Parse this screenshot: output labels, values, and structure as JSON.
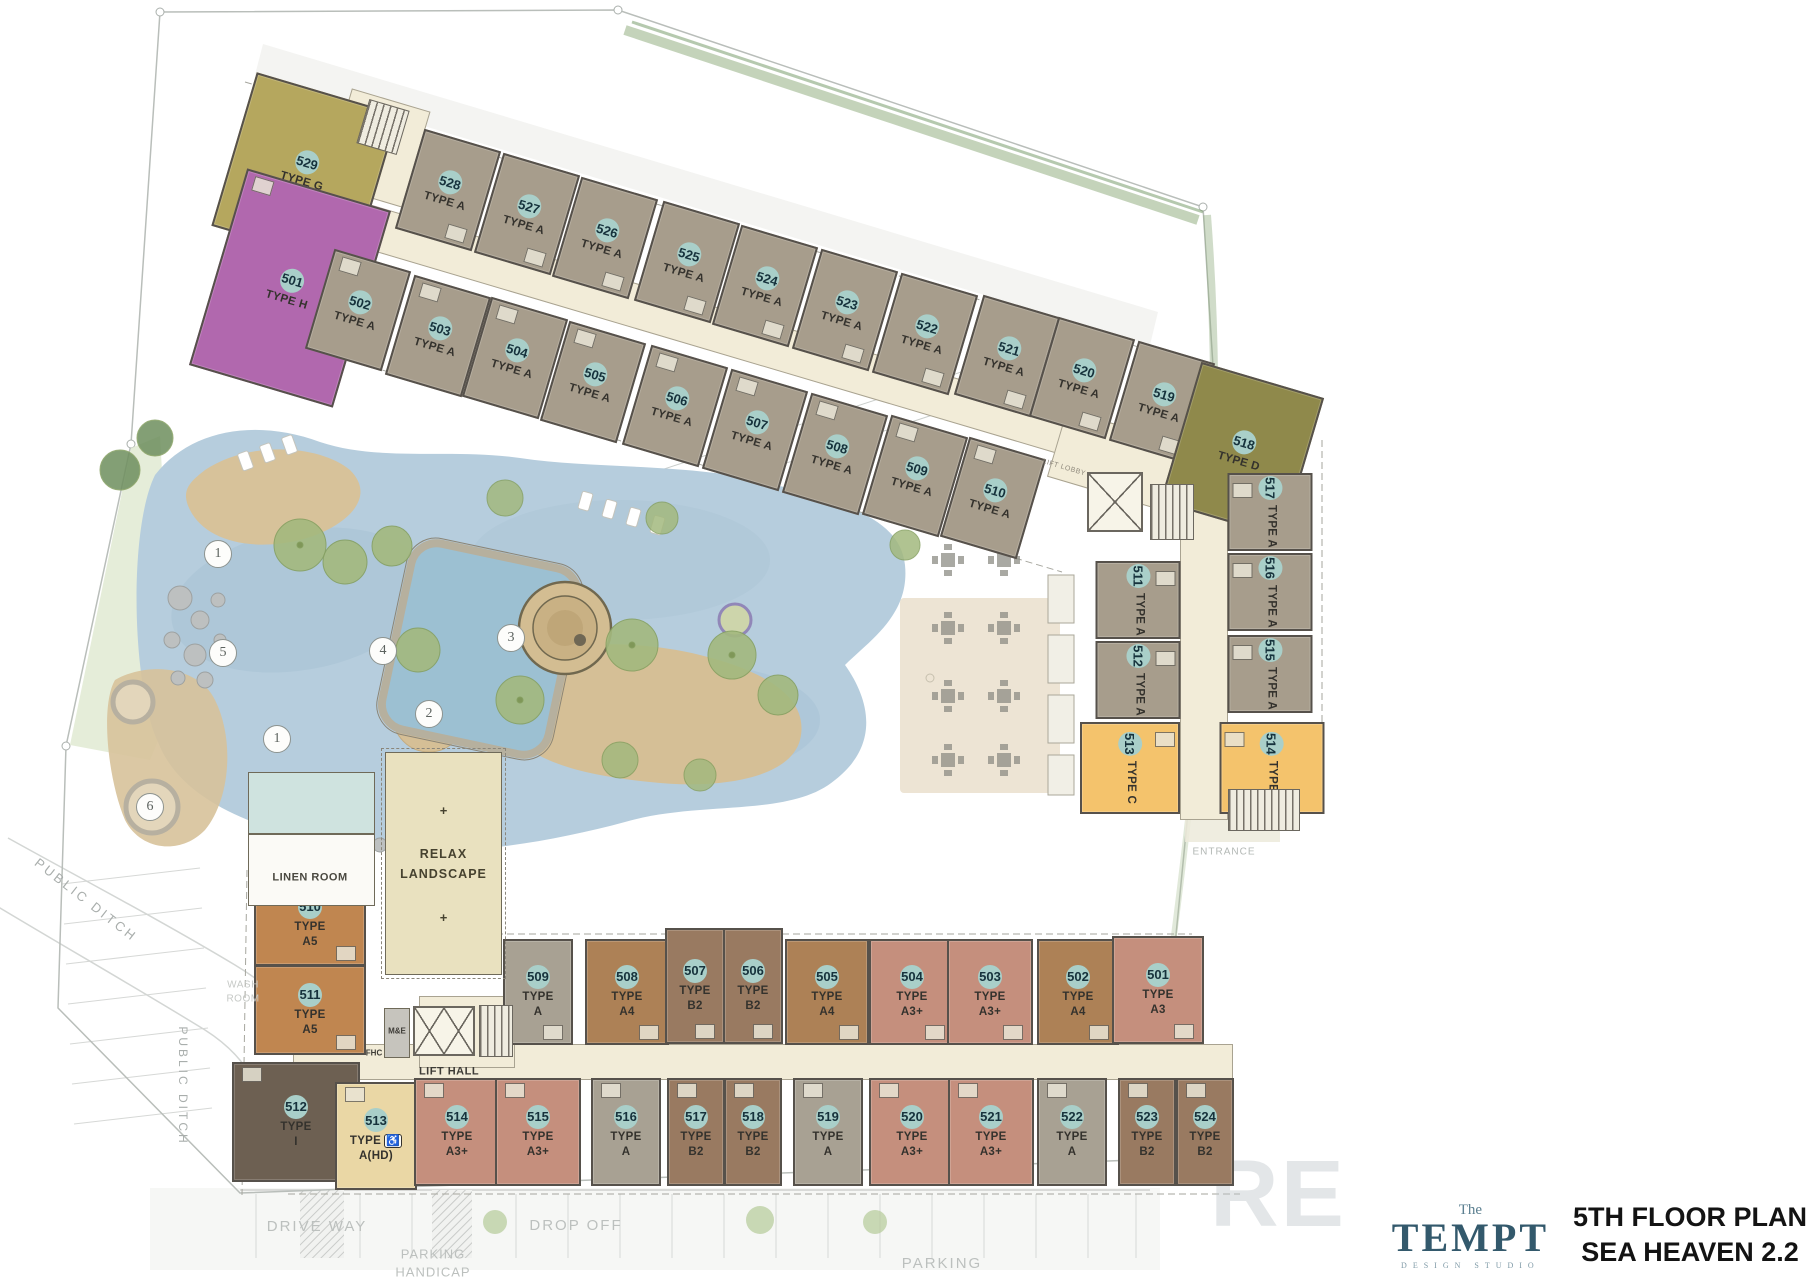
{
  "title_block": {
    "brand_pre": "The",
    "brand": "TEMPT",
    "brand_sub": "DESIGN STUDIO",
    "title_line1": "5TH FLOOR PLAN",
    "title_line2": "SEA HEAVEN 2.2"
  },
  "watermark": "RE",
  "icons": {
    "handicap": "♿"
  },
  "palette": {
    "ta": "#a79d8c",
    "g": "#b5a75e",
    "h": "#b168ae",
    "d": "#8f894b",
    "c": "#f4c36c",
    "a5": "#c08650",
    "i": "#6d6052",
    "ahd": "#ead7a5",
    "a3": "#c58f7d",
    "ab": "#a8a193",
    "b2": "#997a61",
    "a4": "#ad8156",
    "corridor": "#f2ecd8",
    "number_circle": "#a9cfc9",
    "wall": "#56514b",
    "logo_teal": "#33596c",
    "pool_blue": "#b6cddd",
    "sand": "#d7c29a"
  },
  "wings": {
    "top": {
      "rot": 16.5,
      "mode": "s2",
      "fill": "ta",
      "units": [
        {
          "no": "529",
          "t": "TYPE G",
          "x": 305,
          "y": 170,
          "w": 148,
          "h": 160,
          "f": "g",
          "fs": "b"
        },
        {
          "no": "528",
          "t": "TYPE A",
          "x": 448,
          "y": 190,
          "w": 80,
          "h": 104,
          "fs": "b"
        },
        {
          "no": "527",
          "t": "TYPE A",
          "x": 527,
          "y": 214,
          "w": 80,
          "h": 104,
          "fs": "b"
        },
        {
          "no": "526",
          "t": "TYPE A",
          "x": 605,
          "y": 238,
          "w": 80,
          "h": 104,
          "fs": "b"
        },
        {
          "no": "525",
          "t": "TYPE A",
          "x": 687,
          "y": 262,
          "w": 80,
          "h": 104,
          "fs": "b"
        },
        {
          "no": "524",
          "t": "TYPE A",
          "x": 765,
          "y": 286,
          "w": 80,
          "h": 104,
          "fs": "b"
        },
        {
          "no": "523",
          "t": "TYPE A",
          "x": 845,
          "y": 310,
          "w": 80,
          "h": 104,
          "fs": "b"
        },
        {
          "no": "522",
          "t": "TYPE A",
          "x": 925,
          "y": 334,
          "w": 80,
          "h": 104,
          "fs": "b"
        },
        {
          "no": "521",
          "t": "TYPE A",
          "x": 1007,
          "y": 356,
          "w": 80,
          "h": 104,
          "fs": "b"
        },
        {
          "no": "520",
          "t": "TYPE A",
          "x": 1082,
          "y": 378,
          "w": 80,
          "h": 104,
          "fs": "b"
        },
        {
          "no": "519",
          "t": "TYPE A",
          "x": 1162,
          "y": 402,
          "w": 80,
          "h": 104,
          "fs": "b"
        },
        {
          "no": "518",
          "t": "TYPE D",
          "x": 1242,
          "y": 450,
          "w": 128,
          "h": 146,
          "f": "d",
          "fs": "b"
        },
        {
          "no": "501",
          "t": "TYPE H",
          "x": 290,
          "y": 288,
          "w": 150,
          "h": 205,
          "f": "h",
          "fs": "t"
        },
        {
          "no": "502",
          "t": "TYPE A",
          "x": 358,
          "y": 310,
          "w": 80,
          "h": 104,
          "fs": "t"
        },
        {
          "no": "503",
          "t": "TYPE A",
          "x": 438,
          "y": 336,
          "w": 80,
          "h": 104,
          "fs": "t"
        },
        {
          "no": "504",
          "t": "TYPE A",
          "x": 515,
          "y": 358,
          "w": 80,
          "h": 104,
          "fs": "t"
        },
        {
          "no": "505",
          "t": "TYPE A",
          "x": 593,
          "y": 382,
          "w": 80,
          "h": 104,
          "fs": "t"
        },
        {
          "no": "506",
          "t": "TYPE A",
          "x": 675,
          "y": 406,
          "w": 80,
          "h": 104,
          "fs": "t"
        },
        {
          "no": "507",
          "t": "TYPE A",
          "x": 755,
          "y": 430,
          "w": 80,
          "h": 104,
          "fs": "t"
        },
        {
          "no": "508",
          "t": "TYPE A",
          "x": 835,
          "y": 454,
          "w": 80,
          "h": 104,
          "fs": "t"
        },
        {
          "no": "509",
          "t": "TYPE A",
          "x": 915,
          "y": 476,
          "w": 80,
          "h": 104,
          "fs": "t"
        },
        {
          "no": "510",
          "t": "TYPE A",
          "x": 993,
          "y": 498,
          "w": 80,
          "h": 104,
          "fs": "t"
        }
      ]
    },
    "right": {
      "rot": 0,
      "mode": "v",
      "fill": "ta",
      "units": [
        {
          "no": "517",
          "t": "TYPE A",
          "x": 1270,
          "y": 512,
          "w": 85,
          "h": 78,
          "fs": "l"
        },
        {
          "no": "516",
          "t": "TYPE A",
          "x": 1270,
          "y": 592,
          "w": 85,
          "h": 78,
          "fs": "l"
        },
        {
          "no": "515",
          "t": "TYPE A",
          "x": 1270,
          "y": 674,
          "w": 85,
          "h": 78,
          "fs": "l"
        },
        {
          "no": "514",
          "t": "TYPE C",
          "x": 1272,
          "y": 768,
          "w": 105,
          "h": 92,
          "f": "c",
          "fs": "l"
        },
        {
          "no": "511",
          "t": "TYPE A",
          "x": 1138,
          "y": 600,
          "w": 85,
          "h": 78,
          "fs": "r"
        },
        {
          "no": "512",
          "t": "TYPE A",
          "x": 1138,
          "y": 680,
          "w": 85,
          "h": 78,
          "fs": "r"
        },
        {
          "no": "513",
          "t": "TYPE C",
          "x": 1130,
          "y": 768,
          "w": 100,
          "h": 92,
          "f": "c",
          "fs": "r"
        }
      ]
    },
    "bottom": {
      "rot": 0,
      "mode": "s3",
      "fill": "ab",
      "units": [
        {
          "no": "510",
          "t": "TYPE A5",
          "x": 310,
          "y": 922,
          "w": 112,
          "h": 88,
          "f": "a5",
          "fs": "b"
        },
        {
          "no": "511",
          "t": "TYPE A5",
          "x": 310,
          "y": 1010,
          "w": 112,
          "h": 90,
          "f": "a5",
          "fs": "b"
        },
        {
          "no": "512",
          "t": "TYPE I",
          "x": 296,
          "y": 1122,
          "w": 128,
          "h": 120,
          "f": "i",
          "fs": "t"
        },
        {
          "no": "513",
          "t": "TYPE A(HD)",
          "x": 376,
          "y": 1136,
          "w": 82,
          "h": 108,
          "f": "ahd",
          "hd": true,
          "fs": "t"
        },
        {
          "no": "509",
          "t": "TYPE A",
          "x": 538,
          "y": 992,
          "w": 70,
          "h": 106,
          "f": "ab",
          "fs": "b"
        },
        {
          "no": "508",
          "t": "TYPE A4",
          "x": 627,
          "y": 992,
          "w": 84,
          "h": 106,
          "f": "a4",
          "fs": "b"
        },
        {
          "no": "507",
          "t": "TYPE B2",
          "x": 695,
          "y": 986,
          "w": 60,
          "h": 116,
          "f": "b2",
          "fs": "b"
        },
        {
          "no": "506",
          "t": "TYPE B2",
          "x": 753,
          "y": 986,
          "w": 60,
          "h": 116,
          "f": "b2",
          "fs": "b"
        },
        {
          "no": "505",
          "t": "TYPE A4",
          "x": 827,
          "y": 992,
          "w": 84,
          "h": 106,
          "f": "a4",
          "fs": "b"
        },
        {
          "no": "504",
          "t": "TYPE A3+",
          "x": 912,
          "y": 992,
          "w": 86,
          "h": 106,
          "f": "a3",
          "fs": "b"
        },
        {
          "no": "503",
          "t": "TYPE A3+",
          "x": 990,
          "y": 992,
          "w": 86,
          "h": 106,
          "f": "a3",
          "fs": "b"
        },
        {
          "no": "502",
          "t": "TYPE A4",
          "x": 1078,
          "y": 992,
          "w": 82,
          "h": 106,
          "f": "a4",
          "fs": "b"
        },
        {
          "no": "501",
          "t": "TYPE A3",
          "x": 1158,
          "y": 990,
          "w": 92,
          "h": 108,
          "f": "a3",
          "fs": "b"
        },
        {
          "no": "514",
          "t": "TYPE A3+",
          "x": 457,
          "y": 1132,
          "w": 86,
          "h": 108,
          "f": "a3",
          "fs": "t"
        },
        {
          "no": "515",
          "t": "TYPE A3+",
          "x": 538,
          "y": 1132,
          "w": 86,
          "h": 108,
          "f": "a3",
          "fs": "t"
        },
        {
          "no": "516",
          "t": "TYPE A",
          "x": 626,
          "y": 1132,
          "w": 70,
          "h": 108,
          "f": "ab",
          "fs": "t"
        },
        {
          "no": "517",
          "t": "TYPE B2",
          "x": 696,
          "y": 1132,
          "w": 58,
          "h": 108,
          "f": "b2",
          "fs": "t"
        },
        {
          "no": "518",
          "t": "TYPE B2",
          "x": 753,
          "y": 1132,
          "w": 58,
          "h": 108,
          "f": "b2",
          "fs": "t"
        },
        {
          "no": "519",
          "t": "TYPE A",
          "x": 828,
          "y": 1132,
          "w": 70,
          "h": 108,
          "f": "ab",
          "fs": "t"
        },
        {
          "no": "520",
          "t": "TYPE A3+",
          "x": 912,
          "y": 1132,
          "w": 86,
          "h": 108,
          "f": "a3",
          "fs": "t"
        },
        {
          "no": "521",
          "t": "TYPE A3+",
          "x": 991,
          "y": 1132,
          "w": 86,
          "h": 108,
          "f": "a3",
          "fs": "t"
        },
        {
          "no": "522",
          "t": "TYPE A",
          "x": 1072,
          "y": 1132,
          "w": 70,
          "h": 108,
          "f": "ab",
          "fs": "t"
        },
        {
          "no": "523",
          "t": "TYPE B2",
          "x": 1147,
          "y": 1132,
          "w": 58,
          "h": 108,
          "f": "b2",
          "fs": "t"
        },
        {
          "no": "524",
          "t": "TYPE B2",
          "x": 1205,
          "y": 1132,
          "w": 58,
          "h": 108,
          "f": "b2",
          "fs": "t"
        }
      ]
    }
  },
  "geometry": {
    "corridors": [
      {
        "x": 700,
        "y": 325,
        "w": 780,
        "h": 44,
        "r": 16.5
      },
      {
        "x": 1148,
        "y": 470,
        "w": 190,
        "h": 70,
        "r": 16.5
      },
      {
        "x": 1204,
        "y": 640,
        "w": 48,
        "h": 360,
        "r": 0
      },
      {
        "x": 763,
        "y": 1062,
        "w": 940,
        "h": 36,
        "r": 0
      },
      {
        "x": 467,
        "y": 1032,
        "w": 96,
        "h": 72,
        "r": 0
      },
      {
        "x": 377,
        "y": 148,
        "w": 82,
        "h": 100,
        "r": 16.5
      }
    ],
    "stairs": [
      {
        "x": 383,
        "y": 127,
        "w": 42,
        "h": 46,
        "r": 16.5
      },
      {
        "x": 1172,
        "y": 512,
        "w": 44,
        "h": 56,
        "r": 0
      },
      {
        "x": 496,
        "y": 1031,
        "w": 34,
        "h": 52,
        "r": 0
      },
      {
        "x": 1264,
        "y": 810,
        "w": 72,
        "h": 42,
        "r": 0
      }
    ],
    "lifts": [
      {
        "x": 1115,
        "y": 502,
        "w": 56,
        "h": 60,
        "r": 0,
        "one": true
      },
      {
        "x": 444,
        "y": 1031,
        "w": 62,
        "h": 50,
        "r": 0,
        "one": false
      }
    ]
  },
  "amenities": {
    "relax_line1": "RELAX",
    "relax_line2": "LANDSCAPE",
    "plus": "+"
  },
  "site_labels": [
    {
      "text": "PUBLIC DITCH",
      "x": 86,
      "y": 900,
      "rot": 38,
      "size": 13,
      "ls": 3,
      "color": "#a9aeac",
      "bold": false
    },
    {
      "text": "PUBLIC DITCH",
      "x": 183,
      "y": 1086,
      "rot": 90,
      "size": 12,
      "ls": 3,
      "color": "#a9aeac",
      "bold": false
    },
    {
      "text": "DRIVE WAY",
      "x": 317,
      "y": 1227,
      "rot": 0,
      "size": 15,
      "ls": 2,
      "color": "#bcc0be",
      "bold": false
    },
    {
      "text": "DROP OFF",
      "x": 576,
      "y": 1226,
      "rot": 0,
      "size": 15,
      "ls": 2,
      "color": "#bcc0be",
      "bold": false
    },
    {
      "text": "PARKING\nHANDICAP",
      "x": 433,
      "y": 1263,
      "rot": 0,
      "size": 13,
      "ls": 1,
      "color": "#bcc0be",
      "bold": false
    },
    {
      "text": "PARKING",
      "x": 942,
      "y": 1264,
      "rot": 0,
      "size": 15,
      "ls": 2,
      "color": "#bcc0be",
      "bold": false
    },
    {
      "text": "ENTRANCE",
      "x": 1224,
      "y": 852,
      "rot": 0,
      "size": 10,
      "ls": 1,
      "color": "#b3b8b5",
      "bold": false
    },
    {
      "text": "WASH\nROOM",
      "x": 243,
      "y": 992,
      "rot": 0,
      "size": 10,
      "ls": 0.5,
      "color": "#c6c9c6",
      "bold": false
    },
    {
      "text": "LIFT LOBBY",
      "x": 1064,
      "y": 468,
      "rot": 16.5,
      "size": 7,
      "ls": 0.5,
      "color": "#8f897c",
      "bold": false
    },
    {
      "text": "LIFT HALL",
      "x": 449,
      "y": 1072,
      "rot": 0,
      "size": 11,
      "ls": 0.5,
      "color": "#3d3b36",
      "bold": true
    },
    {
      "text": "LINEN ROOM",
      "x": 310,
      "y": 878,
      "rot": 0,
      "size": 11,
      "ls": 0.5,
      "color": "#4a4840",
      "bold": true
    },
    {
      "text": "M&E",
      "x": 397,
      "y": 1032,
      "rot": 0,
      "size": 8,
      "ls": 0,
      "color": "#3d3b36",
      "bold": true
    },
    {
      "text": "FHC",
      "x": 374,
      "y": 1054,
      "rot": 0,
      "size": 8,
      "ls": 0,
      "color": "#3d3b36",
      "bold": true
    }
  ],
  "pool_markers": [
    {
      "n": "1",
      "x": 218,
      "y": 554
    },
    {
      "n": "3",
      "x": 511,
      "y": 638
    },
    {
      "n": "4",
      "x": 383,
      "y": 651
    },
    {
      "n": "5",
      "x": 223,
      "y": 653
    },
    {
      "n": "2",
      "x": 429,
      "y": 714
    },
    {
      "n": "1",
      "x": 277,
      "y": 739
    },
    {
      "n": "6",
      "x": 150,
      "y": 807
    }
  ]
}
